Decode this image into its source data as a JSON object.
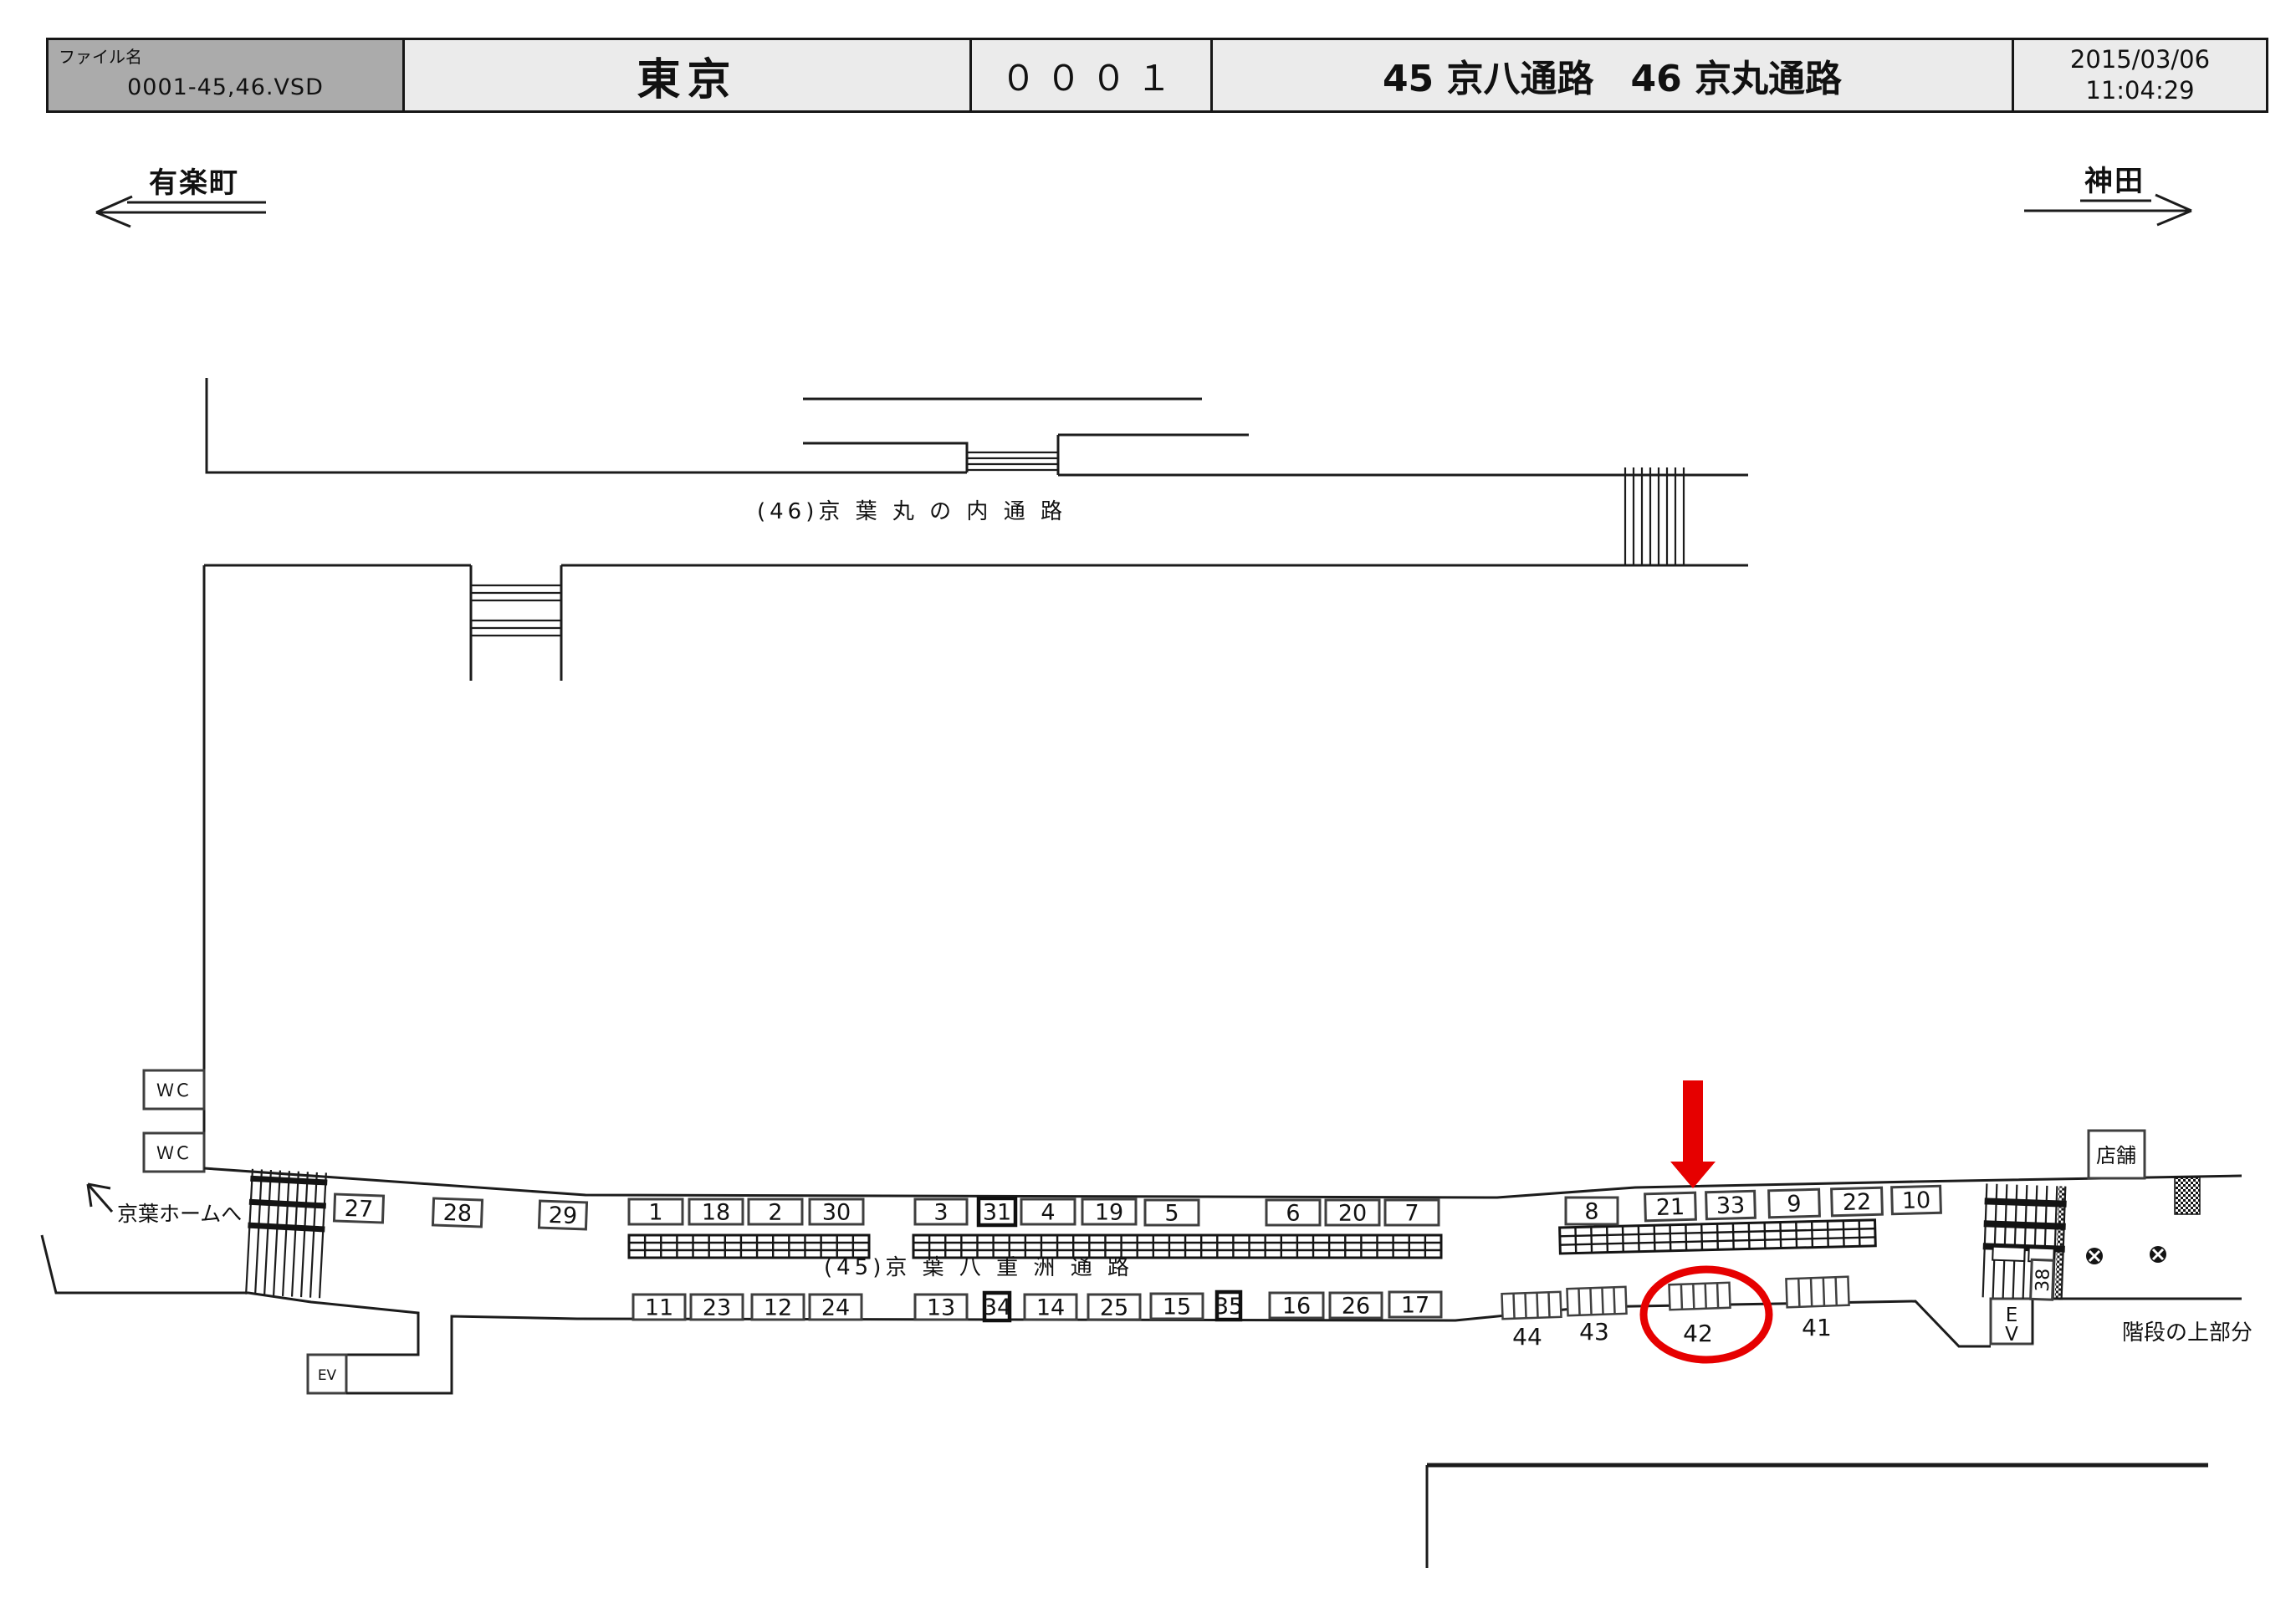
{
  "header": {
    "file_label": "ファイル名",
    "file_value": "0001-45,46.VSD",
    "station": "東京",
    "code": "０００１",
    "title": "45 京八通路　46 京丸通路",
    "date": "2015/03/06",
    "time": "11:04:29"
  },
  "directions": {
    "left": "有楽町",
    "right": "神田"
  },
  "corridors": {
    "upper_label": "(46)京 葉 丸 の 内 通 路",
    "lower_label": "(45)京 葉 八 重 洲 通 路"
  },
  "annotations": {
    "platform_link": "京葉ホームへ",
    "stairs_note": "階段の上部分",
    "shop": "店舗",
    "wc": "ＷＣ",
    "ev_left": "EV",
    "ev_right_line1": "E",
    "ev_right_line2": "V",
    "stair_box": "38",
    "accent_red": "#e60000",
    "highlighted_location": "42",
    "arrow_target_location": "21"
  },
  "boxes": {
    "top_row": [
      "27",
      "28",
      "29",
      "1",
      "18",
      "2",
      "30",
      "3",
      "31",
      "4",
      "19",
      "5",
      "6",
      "20",
      "7",
      "8",
      "21",
      "33",
      "9",
      "22",
      "10"
    ],
    "bottom_row": [
      "11",
      "23",
      "12",
      "24",
      "13",
      "34",
      "14",
      "25",
      "15",
      "35",
      "16",
      "26",
      "17"
    ],
    "floor_groups": [
      "44",
      "43",
      "42",
      "41"
    ]
  }
}
